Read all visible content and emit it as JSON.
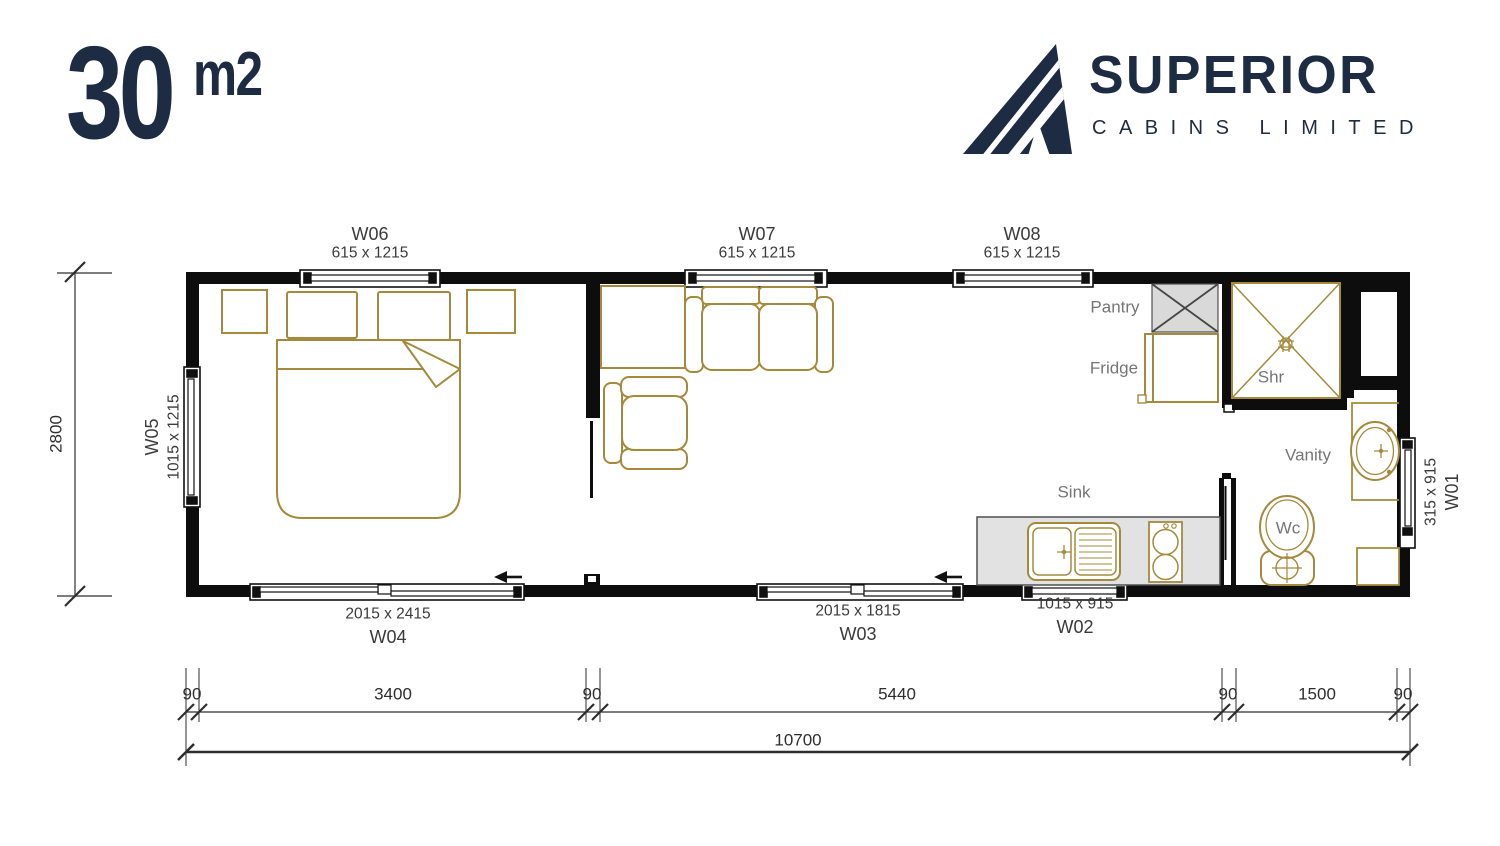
{
  "logo": {
    "number": "30",
    "unit": "m2"
  },
  "brand": {
    "name": "SUPERIOR",
    "tagline": "CABINS LIMITED"
  },
  "windows": {
    "w01": {
      "id": "W01",
      "size": "315 x 915"
    },
    "w02": {
      "id": "W02",
      "size": "1015 x 915"
    },
    "w03": {
      "id": "W03",
      "size": "2015 x 1815"
    },
    "w04": {
      "id": "W04",
      "size": "2015 x 2415"
    },
    "w05": {
      "id": "W05",
      "size": "1015 x 1215"
    },
    "w06": {
      "id": "W06",
      "size": "615 x 1215"
    },
    "w07": {
      "id": "W07",
      "size": "615 x 1215"
    },
    "w08": {
      "id": "W08",
      "size": "615 x 1215"
    }
  },
  "rooms": {
    "pantry": "Pantry",
    "fridge": "Fridge",
    "shower": "Shr",
    "vanity": "Vanity",
    "sink": "Sink",
    "wc": "Wc"
  },
  "dimensions": {
    "overall_length": "10700",
    "overall_width": "2800",
    "segments": [
      "90",
      "3400",
      "90",
      "5440",
      "90",
      "1500",
      "90"
    ]
  },
  "colors": {
    "brand_navy": "#1d2c42",
    "furniture_tan": "#a58a3c",
    "wall_black": "#0d0d0d",
    "label_gray": "#757575",
    "pantry_fill": "#d9d9d9",
    "counter_fill": "#e2e2e2"
  }
}
